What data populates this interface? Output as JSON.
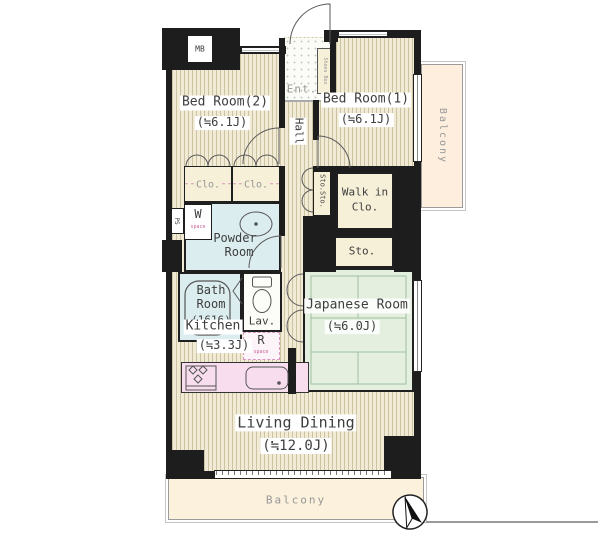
{
  "rooms": {
    "meter_box": {
      "name": "MB"
    },
    "entrance": {
      "name": "Ent."
    },
    "shoes_box": {
      "name": "Shoes Box"
    },
    "bedroom2": {
      "name": "Bed Room(2)",
      "size": "(≒6.1J)"
    },
    "bedroom1": {
      "name": "Bed Room(1)",
      "size": "(≒6.1J)"
    },
    "hall": {
      "name": "Hall"
    },
    "closet1": {
      "name": "Clo."
    },
    "closet2": {
      "name": "Clo."
    },
    "storage_hall": {
      "name": "Sto.Sto."
    },
    "walk_in_closet": {
      "line1": "Walk in",
      "line2": "Clo."
    },
    "storage": {
      "name": "Sto."
    },
    "pipe_space": {
      "name": "PS"
    },
    "washer_space": {
      "letter": "W",
      "caption": "space"
    },
    "powder_room": {
      "line1": "Powder",
      "line2": "Room"
    },
    "bath_room": {
      "line1": "Bath",
      "line2": "Room",
      "size": "(1616)"
    },
    "lavatory": {
      "name": "Lav."
    },
    "refrigerator_space": {
      "letter": "R",
      "caption": "space"
    },
    "kitchen": {
      "name": "Kitchen",
      "size": "(≒3.3J)"
    },
    "japanese_room": {
      "name": "Japanese Room",
      "size": "(≒6.0J)"
    },
    "living_dining": {
      "name": "Living Dining",
      "size": "(≒12.0J)"
    },
    "balcony_bottom": {
      "name": "Balcony"
    },
    "balcony_right": {
      "name": "Balcony"
    }
  },
  "icons": {
    "compass": "north-arrow",
    "bathtub": "bathtub-outline",
    "toilet": "toilet-outline",
    "sink": "wash-basin",
    "stove": "gas-stove-burners",
    "kitchen_sink": "kitchen-sink"
  },
  "colors": {
    "wall": "#1d1d1d",
    "stripe_light": "#f1ebd6",
    "stripe_dark": "#ccc3a2",
    "wet": "#dcedf0",
    "tatami": "#e4efdf",
    "closet": "#f7f0d9",
    "counter": "#f7ddee",
    "balcony_b": "#fbf1dc",
    "balcony_r": "#feeede",
    "txt": "#3e3e3e",
    "muted": "#979797",
    "pink": "#cc6699"
  }
}
